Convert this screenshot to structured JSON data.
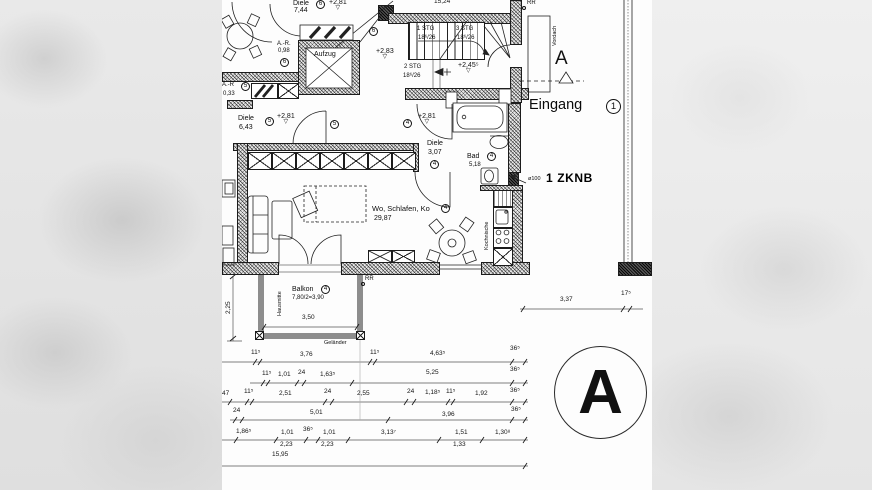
{
  "colors": {
    "paper": "#fdfdfd",
    "ink": "#111111",
    "rail_gray": "#8d8d8d",
    "panel_gray": "#e3e3e3"
  },
  "rooms": {
    "diele7": {
      "name": "Diele",
      "area": "7,44",
      "circ": "6",
      "level": "+2,81"
    },
    "ar_top": {
      "name": "A.-R.",
      "area": "0,98",
      "circ": "6"
    },
    "aufzug": "Aufzug",
    "stairhall": {
      "circ": "6",
      "level": "+2,83"
    },
    "ar_left": {
      "name": "A.-R",
      "circ": "5",
      "area": "0,33"
    },
    "diele6": {
      "name": "Diele",
      "area": "6,43",
      "circ": "5",
      "level": "+2,81",
      "circ2": "5"
    },
    "diele3": {
      "name": "Diele",
      "area": "3,07",
      "circ": "4",
      "level": "+2,81",
      "circ_hall": "4"
    },
    "bad": {
      "name": "Bad",
      "area": "5,18",
      "circ": "4"
    },
    "main": {
      "name": "Wo, Schlafen, Ko",
      "circ": "4",
      "area": "29,87"
    },
    "kitchen": "Kochnische",
    "balkon": {
      "name": "Balkon",
      "circ": "4",
      "calc": "7,80/2=3,90",
      "width": "3,50",
      "hausmitte": "Hausmitte",
      "gelaender": "Geländer"
    }
  },
  "stairs": {
    "f1": "1 STG",
    "f1r": "18⁶/26",
    "f3": "3 STG",
    "f3r": "18⁶/26",
    "f2": "2 STG",
    "f2r": "18⁶/26",
    "level": "+2,45⁵"
  },
  "annotations": {
    "eingang": "Eingang",
    "eingang_circ": "1",
    "zknb": "1 ZKNB",
    "vordach": "Vordach",
    "rr_top": "RR",
    "rr_balkon": "RR",
    "pipe": "ø100",
    "section_letter": "A",
    "big_section_letter": "A",
    "dim_top": "15,24",
    "dim_right_a": "3,37",
    "dim_right_b": "17⁵",
    "dim_vert": "2,25"
  },
  "dims": {
    "rowA": [
      "11⁵",
      "3,76",
      "11⁵",
      "4,63⁵",
      "36⁵"
    ],
    "rowB": [
      "11⁵",
      "1,01",
      "24",
      "1,63⁵",
      "5,25",
      "36⁵"
    ],
    "rowC": [
      "47",
      "11⁵",
      "2,51",
      "24",
      "2,55",
      "24",
      "1,18⁵",
      "11⁵",
      "1,92",
      "36⁵"
    ],
    "rowD": [
      "24",
      "5,01",
      "3,96",
      "36⁵"
    ],
    "rowE": [
      "1,86⁵",
      "1,01",
      "2,23",
      "36⁵",
      "1,01",
      "2,23",
      "3,13⁷",
      "1,51",
      "1,33",
      "1,30⁸"
    ],
    "rowF": [
      "15,95"
    ]
  }
}
